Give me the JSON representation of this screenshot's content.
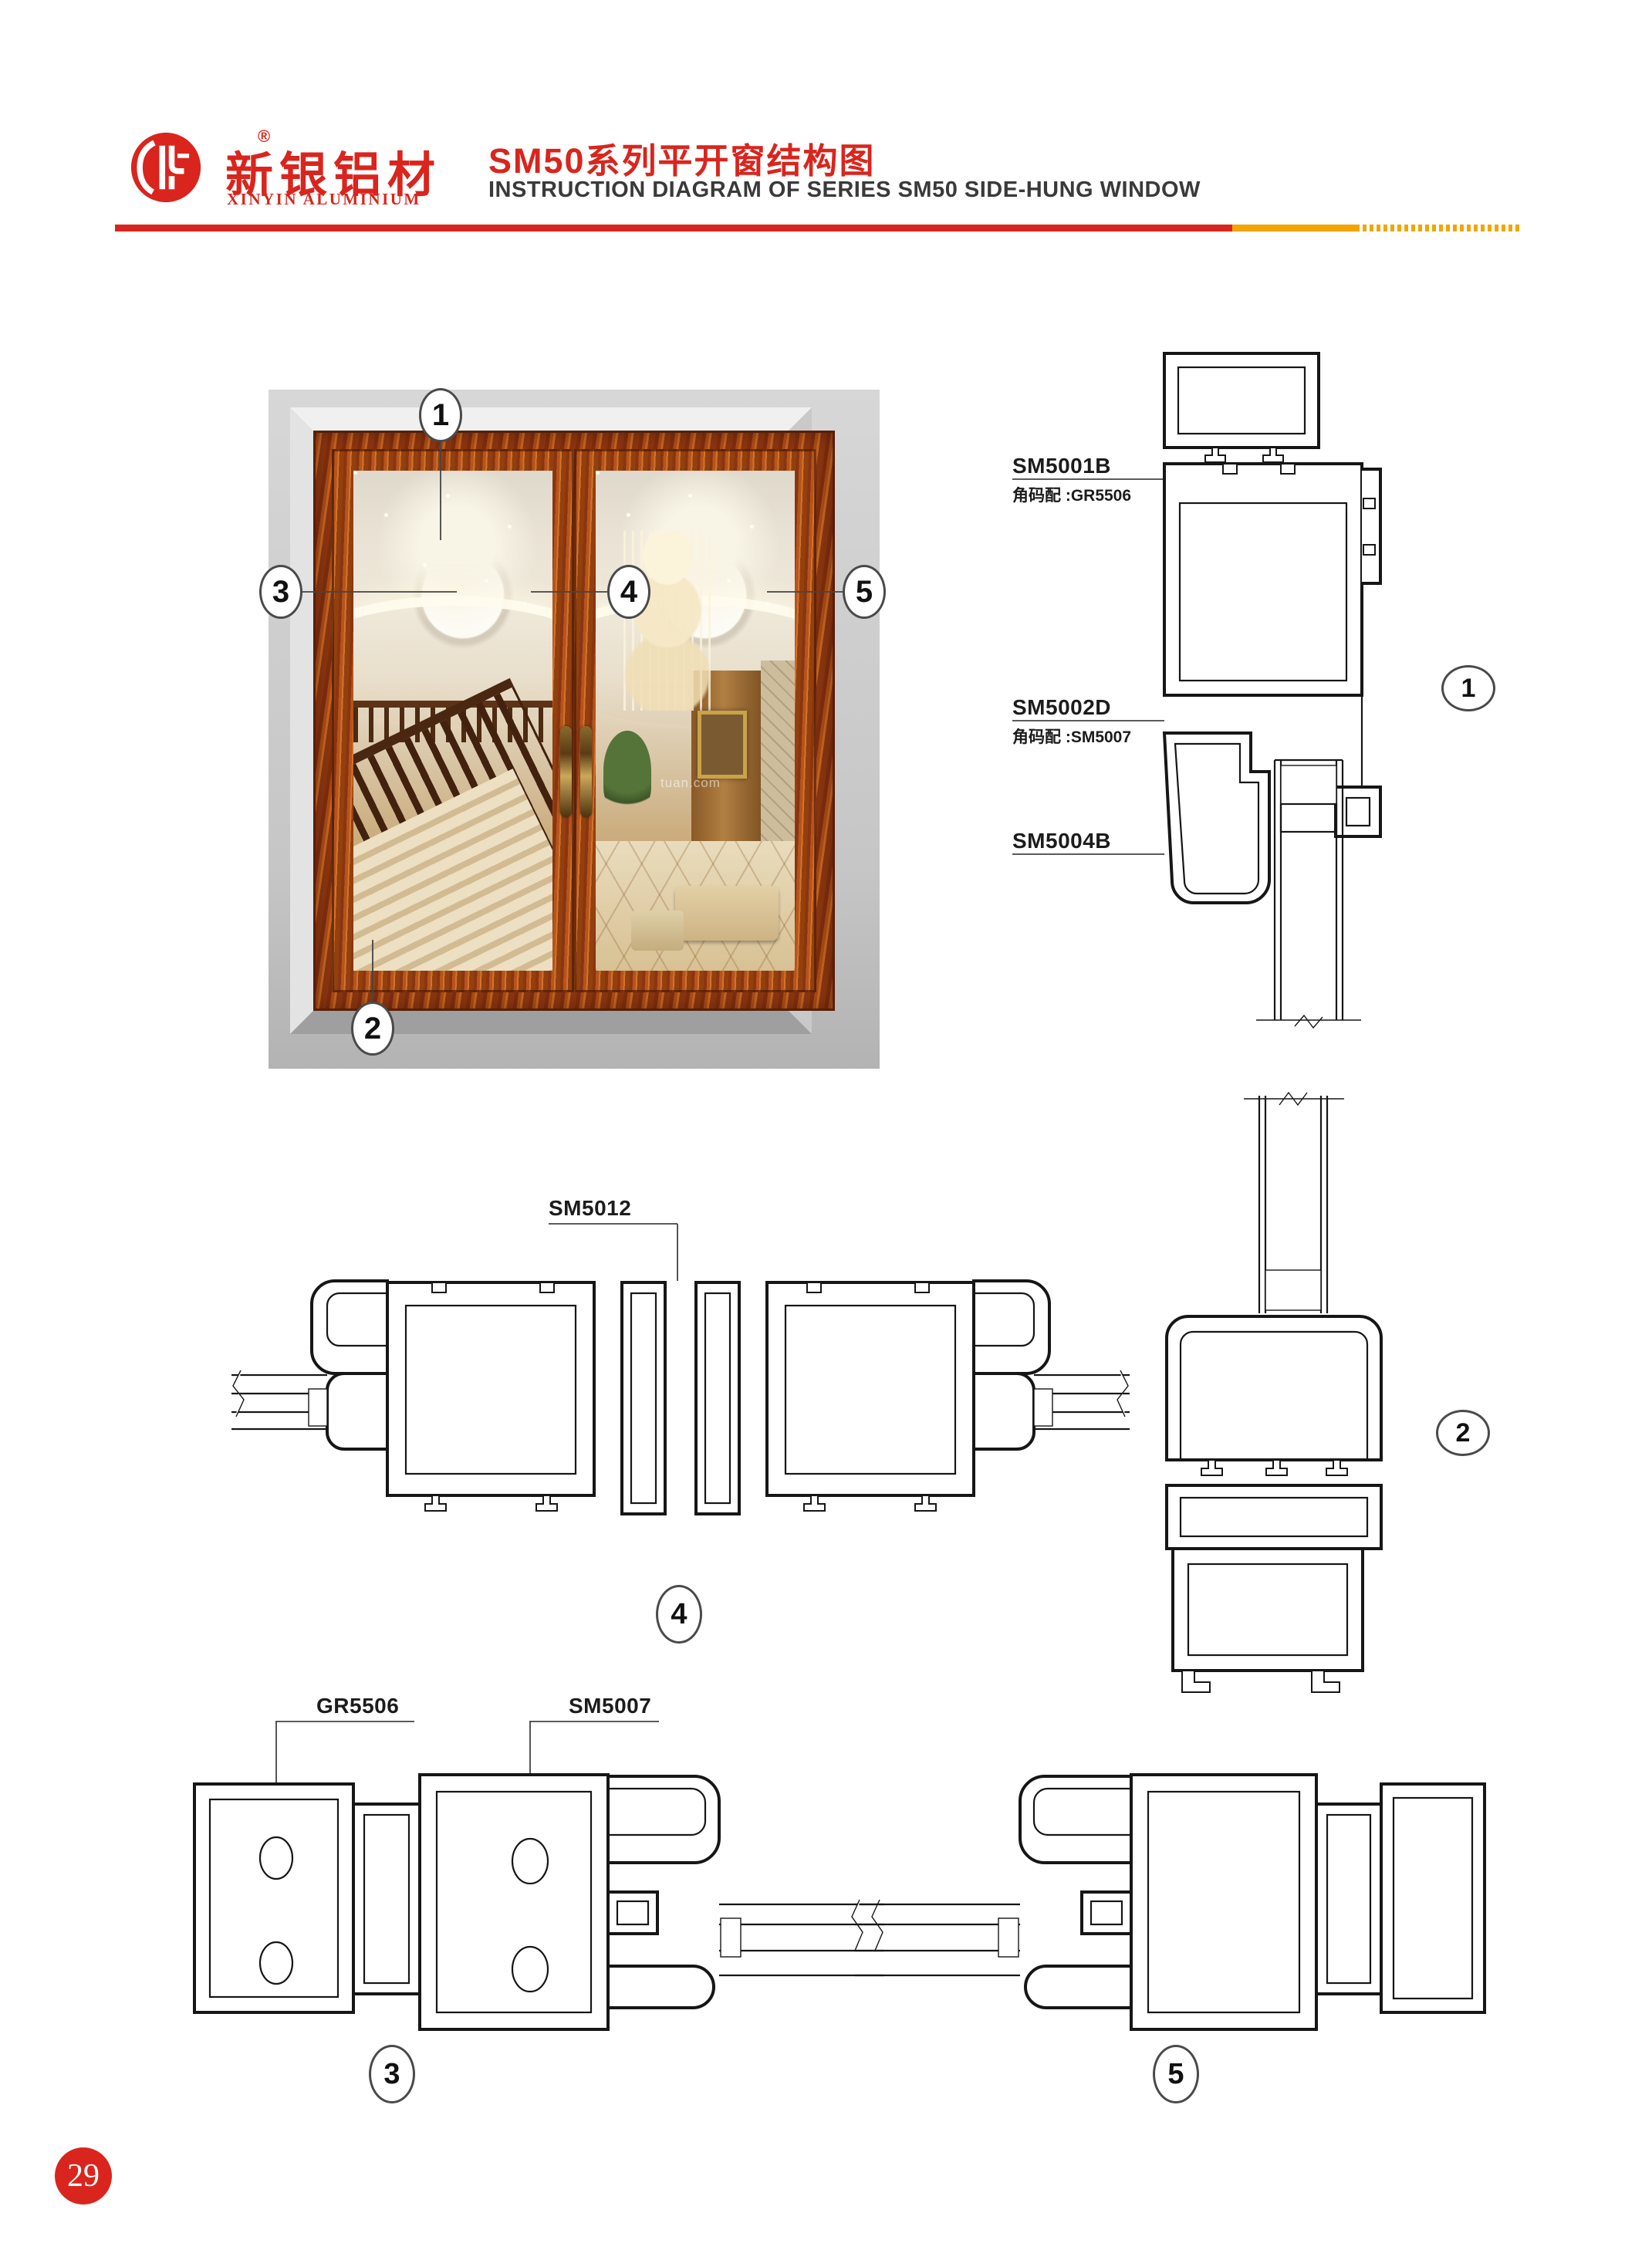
{
  "header": {
    "logo_cn": "新银铝材",
    "logo_en": "XINYIN ALUMINIUM",
    "reg_mark": "®",
    "title_cn": "SM50系列平开窗结构图",
    "title_en": "INSTRUCTION DIAGRAM OF SERIES SM50 SIDE-HUNG WINDOW",
    "accent_red": "#d9251d",
    "accent_amber": "#f2a500"
  },
  "photo": {
    "watermark": "tuan.com"
  },
  "labels": {
    "sm5001b": "SM5001B",
    "sm5001b_note": "角码配 :GR5506",
    "sm5002d": "SM5002D",
    "sm5002d_note": "角码配 :SM5007",
    "sm5004b": "SM5004B",
    "sm5012": "SM5012",
    "gr5506": "GR5506",
    "sm5007": "SM5007"
  },
  "callouts": {
    "c1": "1",
    "c2": "2",
    "c3": "3",
    "c4": "4",
    "c5": "5"
  },
  "section_markers": {
    "m1": "1",
    "m2": "2",
    "m3": "3",
    "m4": "4",
    "m5": "5"
  },
  "footer": {
    "page_number": "29"
  }
}
